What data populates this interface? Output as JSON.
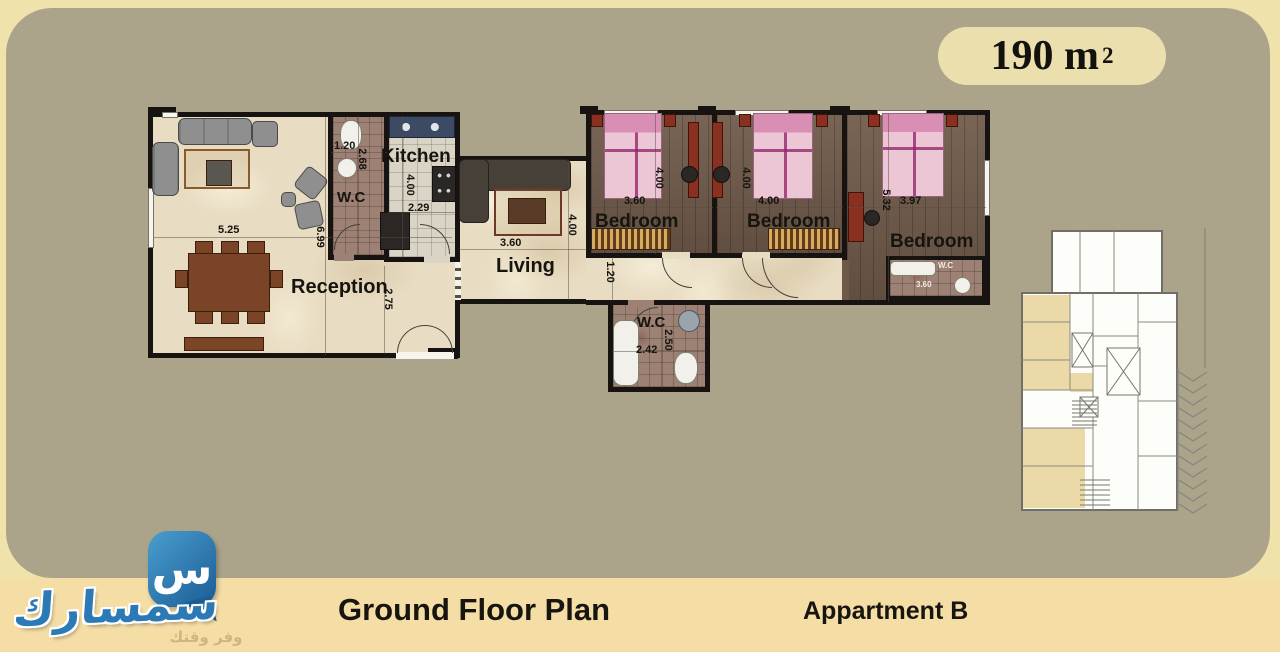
{
  "badge": {
    "area": "190 m",
    "area_exponent": "2"
  },
  "plan": {
    "reception": {
      "label": "Reception",
      "dim_width": "5.25",
      "dim_height": "6.99",
      "dim_side": "2.75"
    },
    "wc_top": {
      "label": "W.C",
      "dim_width": "1.20",
      "dim_height": "2.68"
    },
    "kitchen": {
      "label": "Kitchen",
      "dim_width": "2.29",
      "dim_height": "4.00"
    },
    "living": {
      "label": "Living",
      "dim_width": "3.60",
      "dim_height": "4.00"
    },
    "bedroom1": {
      "label": "Bedroom",
      "dim_width": "3.60",
      "dim_height": "4.00"
    },
    "bedroom2": {
      "label": "Bedroom",
      "dim_width": "4.00",
      "dim_height": "4.00"
    },
    "bedroom3": {
      "label": "Bedroom",
      "dim_width": "3.97",
      "dim_height": "5.32"
    },
    "wc_bottom": {
      "label": "W.C",
      "dim_width": "2.42",
      "dim_height": "2.50"
    },
    "wc_bedroom3": {
      "label": "W.C",
      "dim_width": "3.60"
    },
    "corridor": {
      "dim_width": "1.20"
    }
  },
  "footer": {
    "plan_title": "Ground Floor Plan",
    "apartment_label": "Appartment B"
  },
  "logo": {
    "bubble_glyph": "س",
    "brand": "سمسارك",
    "tagline": "وفر وقتك"
  },
  "colors": {
    "background_olive": "#aba48a",
    "page_border_cream": "#f0e2ab",
    "footer_strip": "#f5dda6",
    "badge_fill": "#ebdfad",
    "wall": "#171310",
    "brand_blue": "#2b7ab5",
    "apartment_highlight": "#ecd9a8",
    "bed_pink": "#edc6d6",
    "wood_floor": "#6e5949"
  }
}
